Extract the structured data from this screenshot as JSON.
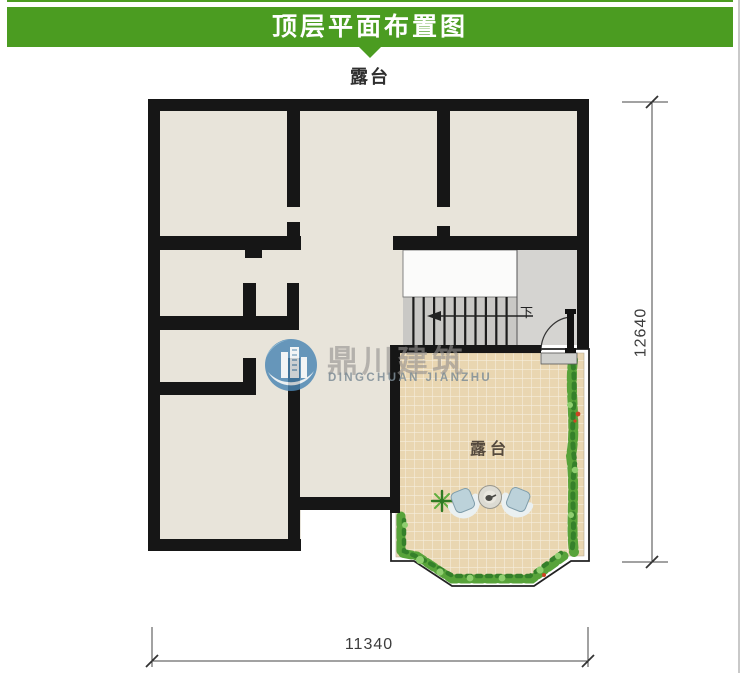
{
  "header": {
    "title": "顶层平面布置图"
  },
  "plan": {
    "top_label": "露台",
    "terrace_label": "露台",
    "stairs": {
      "down_label": "下"
    },
    "dimensions": {
      "width_label": "11340",
      "height_label": "12640"
    }
  },
  "watermark": {
    "name_cn": "鼎川建筑",
    "name_en": "DINGCHUAN JIANZHU"
  },
  "colors": {
    "accent": "#4b9c21",
    "wall": "#161616",
    "floor": "#e8e4da",
    "stair_landing": "#d5d4d1",
    "stair_tread": "#c9c8c5",
    "tile": "#e9d6b1",
    "tile_grout": "#f6eedd",
    "plant": "#58a33a",
    "plant_dark": "#35802a",
    "plant_light": "#8fce6f",
    "dim": "#3c3c3c",
    "chair": "#bcd2da",
    "chair_back": "#eaf0f1",
    "page": "#ffffff"
  }
}
